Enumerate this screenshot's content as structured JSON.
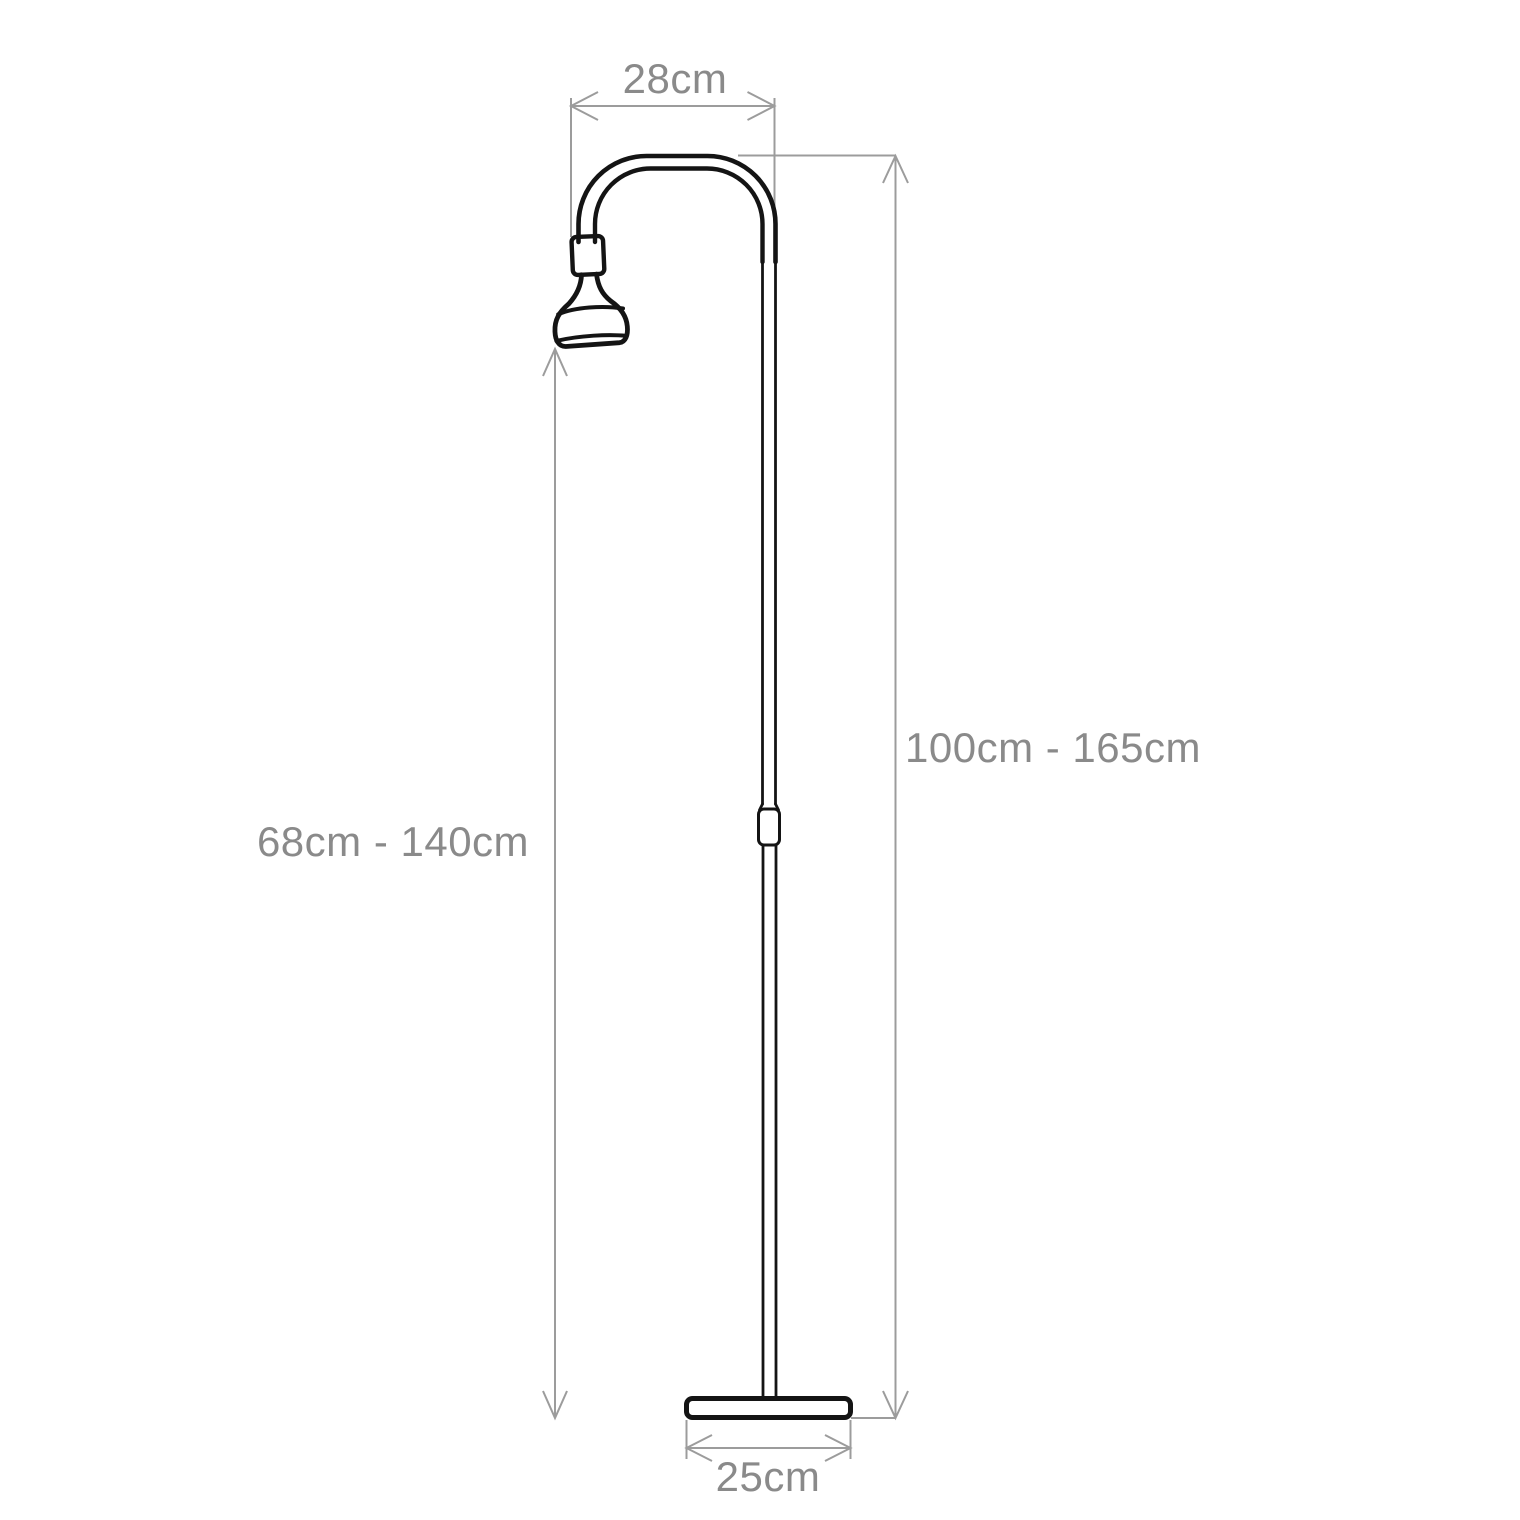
{
  "diagram": {
    "drawing": "adjustable-floor-lamp-line-art",
    "labels": {
      "arm_width": "28cm",
      "overall_height": "100cm - 165cm",
      "bulb_height": "68cm - 140cm",
      "base_width": "25cm"
    },
    "colors": {
      "outline": "#141414",
      "dimension_line": "#9c9c9c",
      "label_text": "#8a8a8a",
      "background": "#ffffff"
    }
  }
}
